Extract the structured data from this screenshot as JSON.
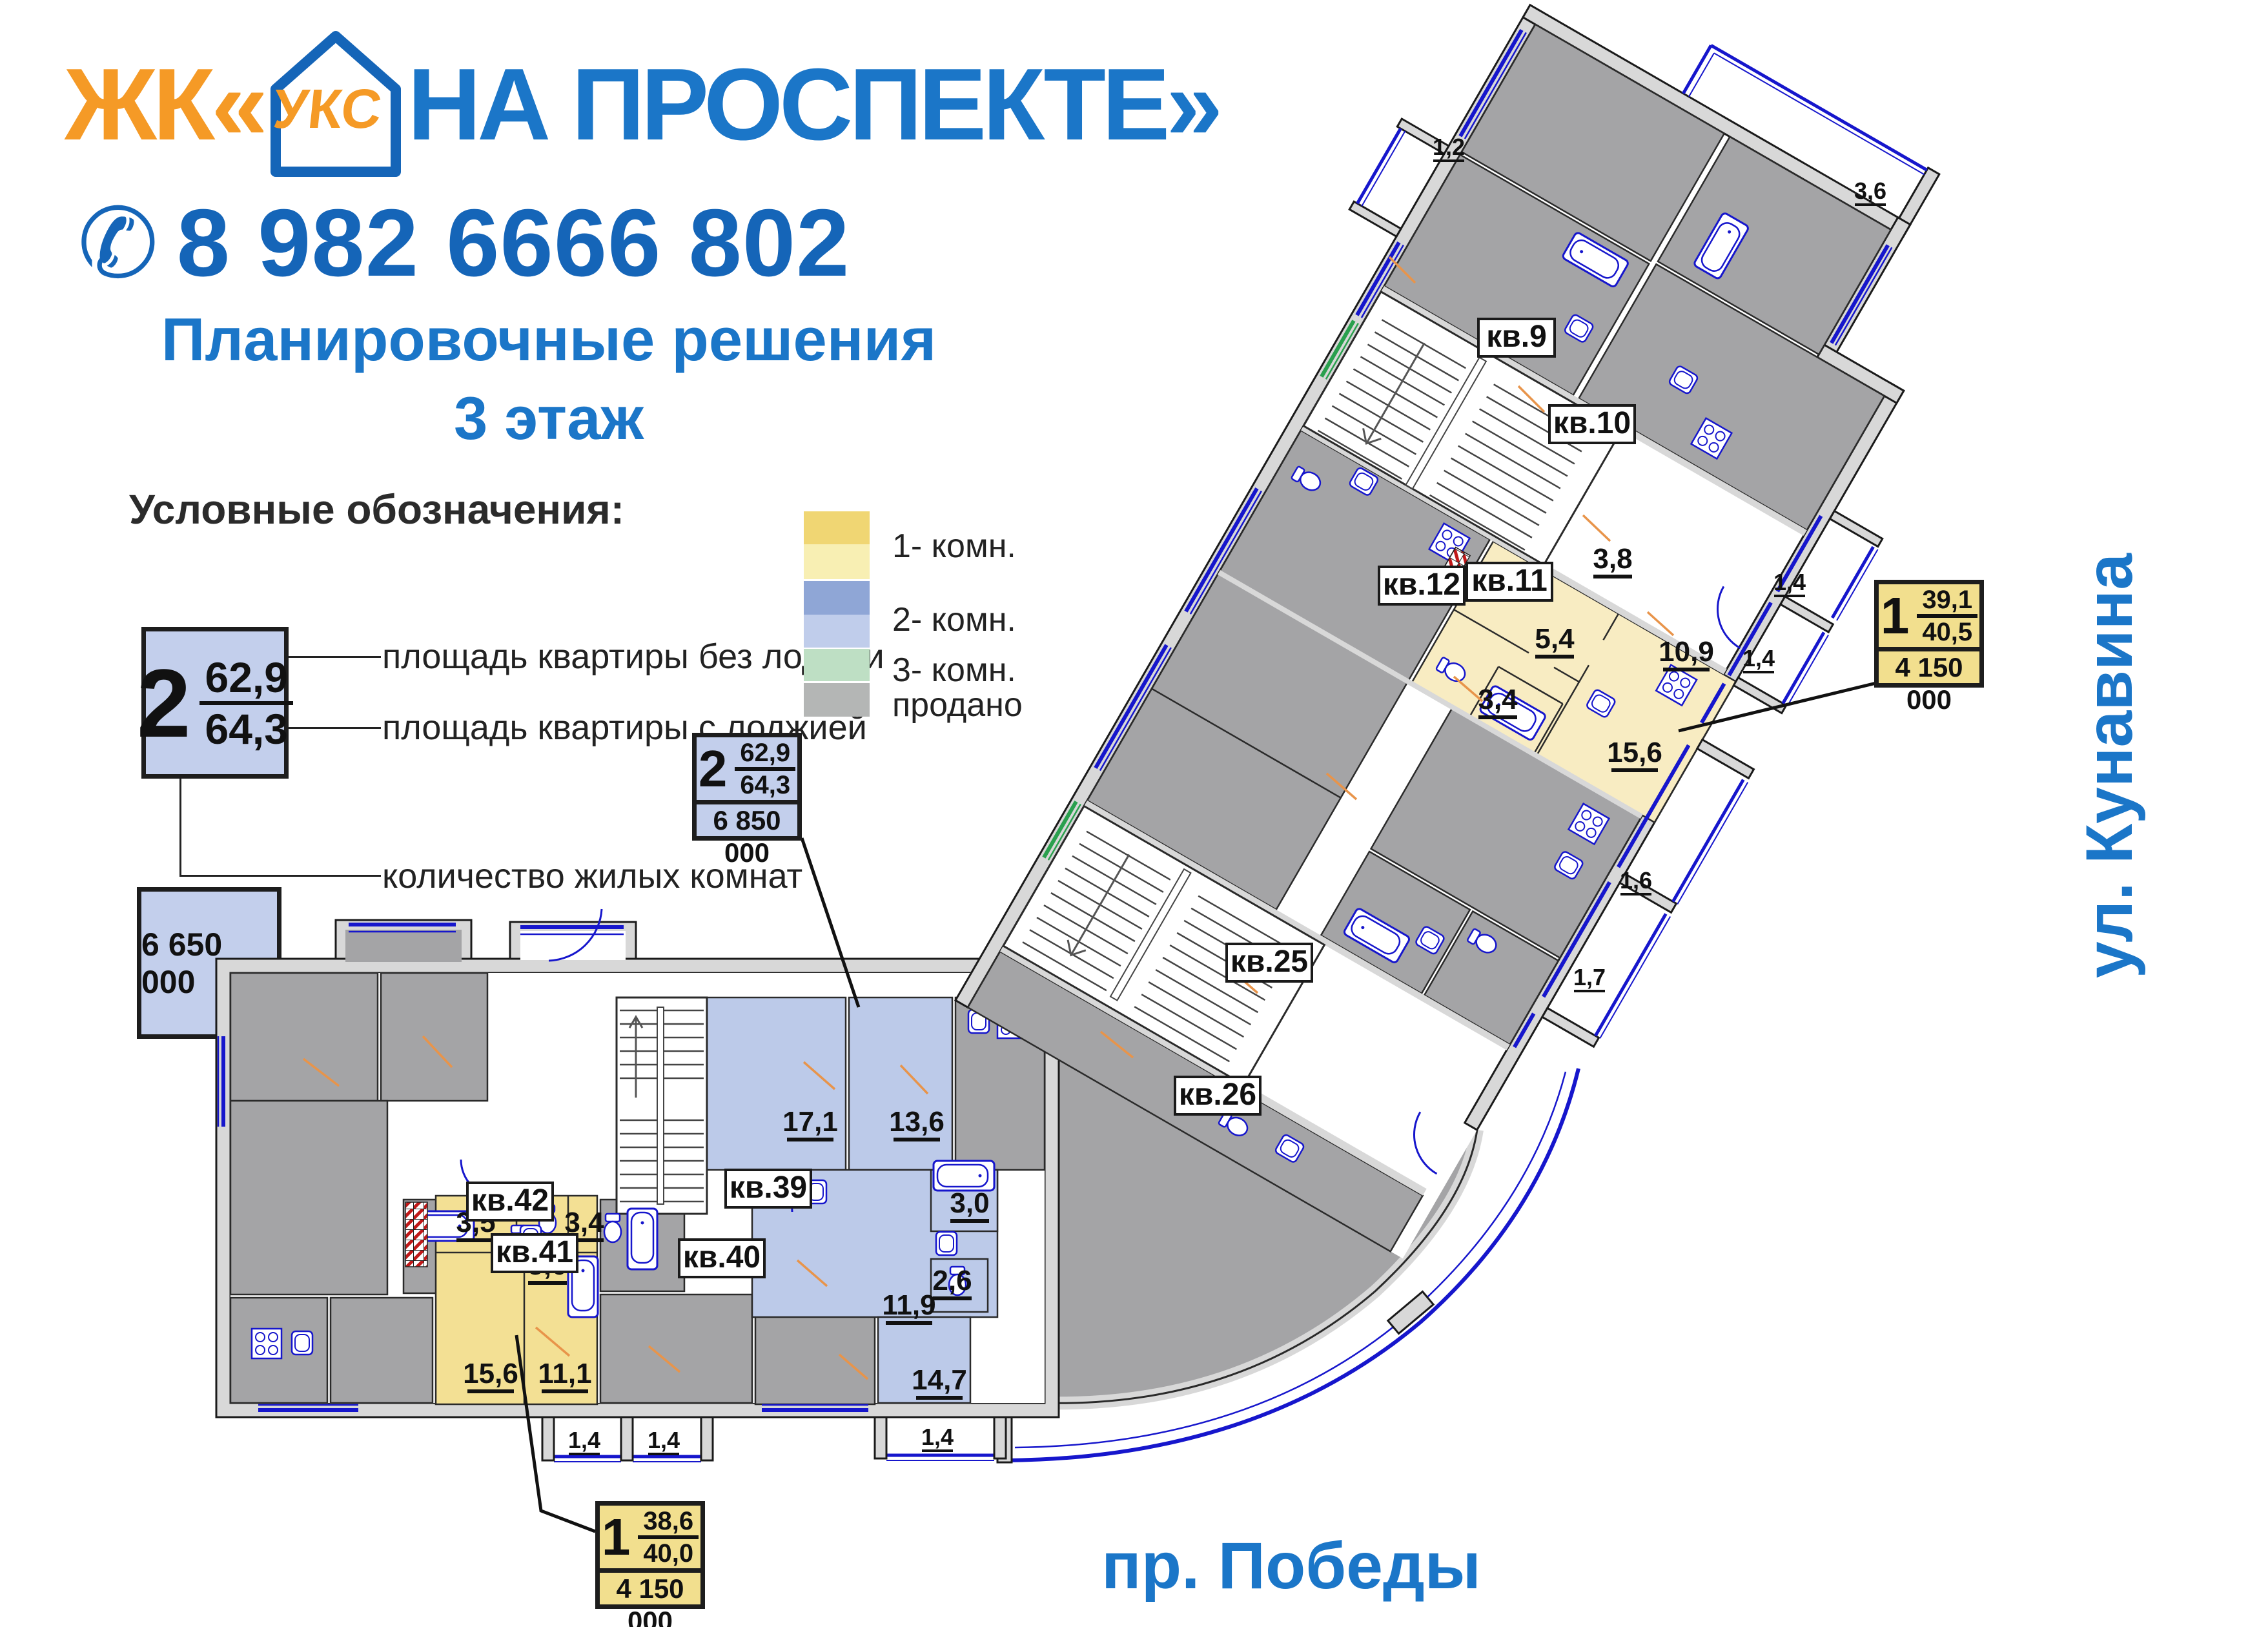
{
  "colors": {
    "accent_blue": "#1b76c8",
    "logo_orange": "#f59a26",
    "phone_blue": "#1565b8",
    "tag_blue": "#c3cfec",
    "tag_yellow": "#f2df8e",
    "apartment_yellow": "#f3e094",
    "apartment_yellow_light": "#f8ecc2",
    "apartment_blue": "#bccae9",
    "sold_gray": "#a4a4a6",
    "wall_gray": "#d8d8d8",
    "window_blue": "#1616cc",
    "window_green": "#2aa04e"
  },
  "header": {
    "logo_prefix": "ЖК«",
    "logo_icon_text": "УКС",
    "logo_suffix": "НА ПРОСПЕКТЕ»",
    "phone_icon": "phone-icon",
    "phone": "8 982 6666 802"
  },
  "title": {
    "line1": "Планировочные решения",
    "line2": "3 этаж"
  },
  "legend": {
    "heading": "Условные обозначения:",
    "sample_rooms": "2",
    "sample_area_top": "62,9",
    "sample_area_bottom": "64,3",
    "sample_price": "6 650 000",
    "caption_area_top": "площадь квартиры без лоджии",
    "caption_area_bottom": "площадь квартиры с лоджией",
    "caption_rooms": "количество жилых комнат",
    "caption_price": "стоимость, руб.",
    "types": [
      {
        "label": "1- комн."
      },
      {
        "label": "2- комн."
      },
      {
        "label": "3- комн."
      },
      {
        "label": "продано"
      }
    ]
  },
  "tags": [
    {
      "rooms": "2",
      "area_top": "62,9",
      "area_bottom": "64,3",
      "price": "6 850 000"
    },
    {
      "rooms": "1",
      "area_top": "39,1",
      "area_bottom": "40,5",
      "price": "4 150 000"
    },
    {
      "rooms": "1",
      "area_top": "38,6",
      "area_bottom": "40,0",
      "price": "4 150 000"
    }
  ],
  "streets": {
    "right": "ул. Кунавина",
    "bottom": "пр. Победы"
  },
  "plan": {
    "apts": {
      "kv9": "кв.9",
      "kv10": "кв.10",
      "kv11": "кв.11",
      "kv12": "кв.12",
      "kv25": "кв.25",
      "kv26": "кв.26",
      "kv39": "кв.39",
      "kv40": "кв.40",
      "kv41": "кв.41",
      "kv42": "кв.42"
    },
    "dims": {
      "d171": "17,1",
      "d136": "13,6",
      "d30": "3,0",
      "d26": "2,6",
      "d119": "11,9",
      "d147": "14,7",
      "d35": "3,5",
      "d50": "5,0",
      "d34a": "3,4",
      "d156a": "15,6",
      "d111": "11,1",
      "d38": "3,8",
      "d54": "5,4",
      "d109": "10,9",
      "d34b": "3,4",
      "d156b": "15,6"
    },
    "balconies": {
      "b14a": "1,4",
      "b14b": "1,4",
      "b14c": "1,4",
      "b14d": "1,4",
      "b14e": "1,4",
      "b16": "1,6",
      "b17": "1,7",
      "b12": "1,2",
      "b36": "3,6"
    }
  }
}
